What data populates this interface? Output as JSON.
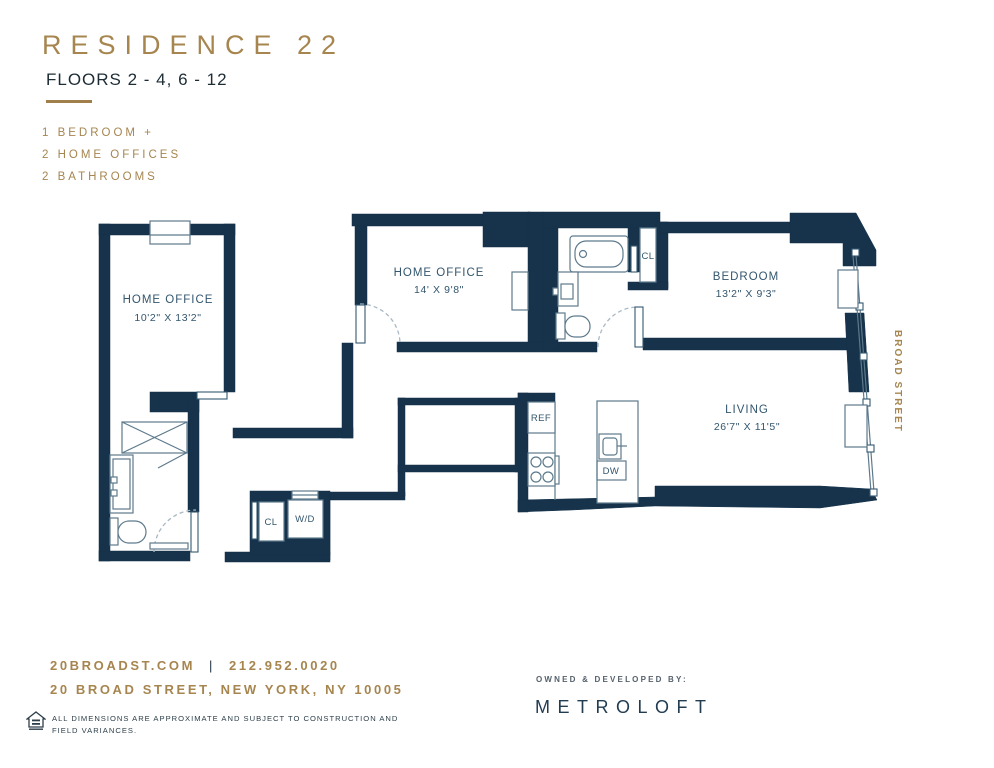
{
  "header": {
    "title": "RESIDENCE 22",
    "floors": "FLOORS 2 - 4, 6 - 12",
    "features": [
      "1 BEDROOM +",
      "2 HOME OFFICES",
      "2 BATHROOMS"
    ]
  },
  "plan": {
    "rooms": {
      "home_office_1": {
        "name": "HOME OFFICE",
        "dims": "10'2\" X 13'2\""
      },
      "home_office_2": {
        "name": "HOME OFFICE",
        "dims": "14' X 9'8\""
      },
      "bedroom": {
        "name": "BEDROOM",
        "dims": "13'2\" X 9'3\""
      },
      "living": {
        "name": "LIVING",
        "dims": "26'7\" X 11'5\""
      }
    },
    "fixtures": {
      "ref": "REF",
      "dw": "DW",
      "wd": "W/D",
      "closet_bath": "CL",
      "closet_foyer": "CL"
    },
    "street": "BROAD STREET"
  },
  "footer": {
    "website": "20BROADST.COM",
    "separator": "|",
    "phone": "212.952.0020",
    "address": "20 BROAD STREET, NEW YORK, NY 10005",
    "disclaimer_line1": "ALL DIMENSIONS ARE APPROXIMATE AND SUBJECT TO CONSTRUCTION AND",
    "disclaimer_line2": "FIELD VARIANCES.",
    "developed_by": "OWNED & DEVELOPED BY:",
    "developer": "METROLOFT"
  },
  "colors": {
    "wall_navy": "#16334b",
    "gold": "#a6854f",
    "label_navy": "#33566e",
    "fixture_line": "#5d7a8c"
  }
}
